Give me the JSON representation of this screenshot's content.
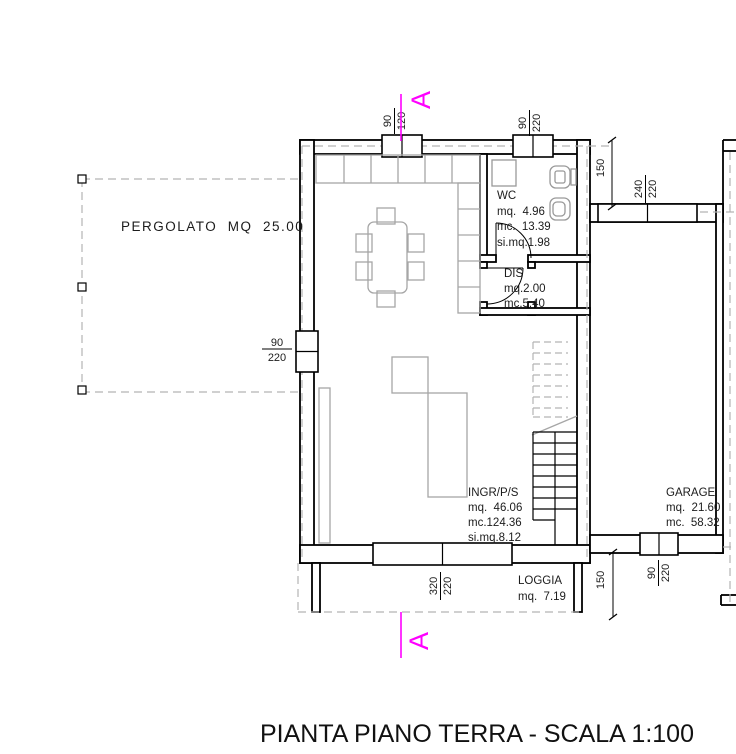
{
  "title": "PIANTA PIANO TERRA - SCALA 1:100",
  "section_mark": "A",
  "pergolato_label": "PERGOLATO  MQ  25.00",
  "rooms": {
    "wc": {
      "name": "WC",
      "l1": "mq.  4.96",
      "l2": "mc.  13.39",
      "l3": "si.mq.1.98"
    },
    "dis": {
      "name": "DIS",
      "l1": "mq.2.00",
      "l2": "mc.5.40"
    },
    "ingr": {
      "name": "INGR/P/S",
      "l1": "mq.  46.06",
      "l2": "mc.124.36",
      "l3": "si.mq.8.12"
    },
    "garage": {
      "name": "GARAGE",
      "l1": "mq.  21.60",
      "l2": "mc.  58.32"
    },
    "loggia": {
      "name": "LOGGIA",
      "l1": "mq.  7.19"
    }
  },
  "openings": {
    "win_a": {
      "num": "90",
      "den": "120"
    },
    "win_b": {
      "num": "90",
      "den": "220"
    },
    "door_left": {
      "num": "90",
      "den": "220"
    },
    "win_loggia": {
      "num": "320",
      "den": "220"
    },
    "garage_front": {
      "num": "240",
      "den": "220"
    },
    "garage_back": {
      "num": "90",
      "den": "220"
    }
  },
  "dimensions": {
    "offset_top": "150",
    "offset_bottom": "150"
  },
  "colors": {
    "section_line": "#ff00ff",
    "walls": "#000000",
    "furniture_gray": "#a6a6a6",
    "overhang_dash": "#b3b3b3",
    "fixtures_gray": "#999999"
  }
}
